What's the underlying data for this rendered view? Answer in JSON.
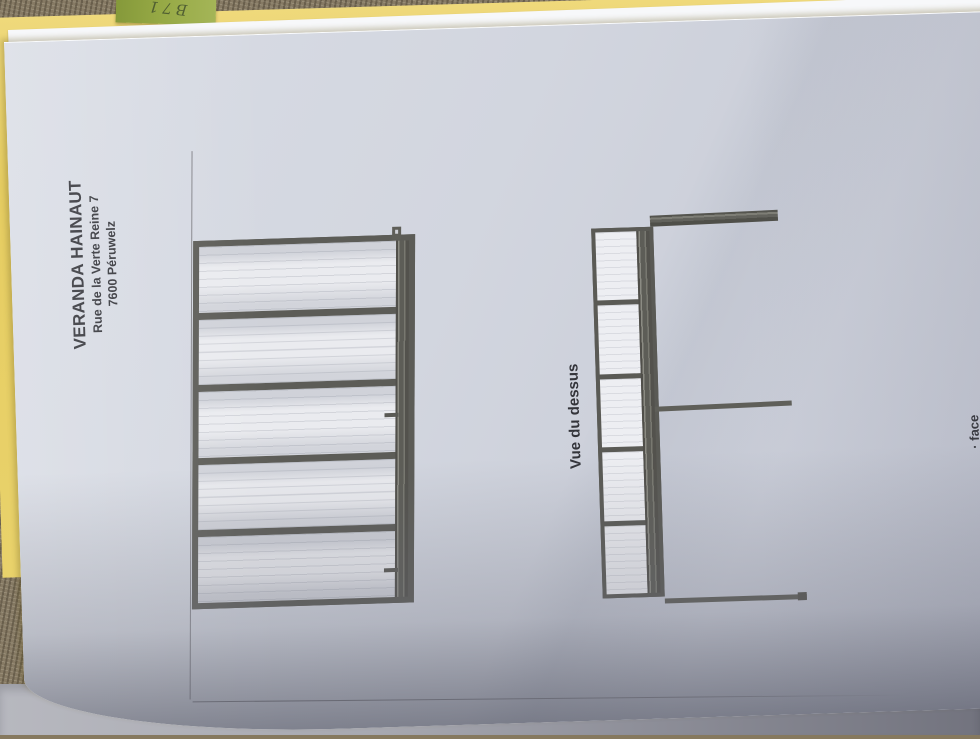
{
  "scene": {
    "note_label": "B71"
  },
  "document": {
    "header": {
      "company": "VERANDA HAINAUT",
      "address1": "Rue de la Verte Reine 7",
      "address2": "7600  Péruwelz"
    },
    "top_view_label": "Vue du dessus",
    "edge_fragment": "· face",
    "elevation": {
      "panel_count": 5
    },
    "top_view": {
      "cell_count": 5
    }
  },
  "colors": {
    "folder": "#e6cd62",
    "note": "#96a945",
    "frame": "#5c5c57",
    "paper": "#e8eaef",
    "carpet": "#86795f",
    "floor": "#a9aab2"
  }
}
